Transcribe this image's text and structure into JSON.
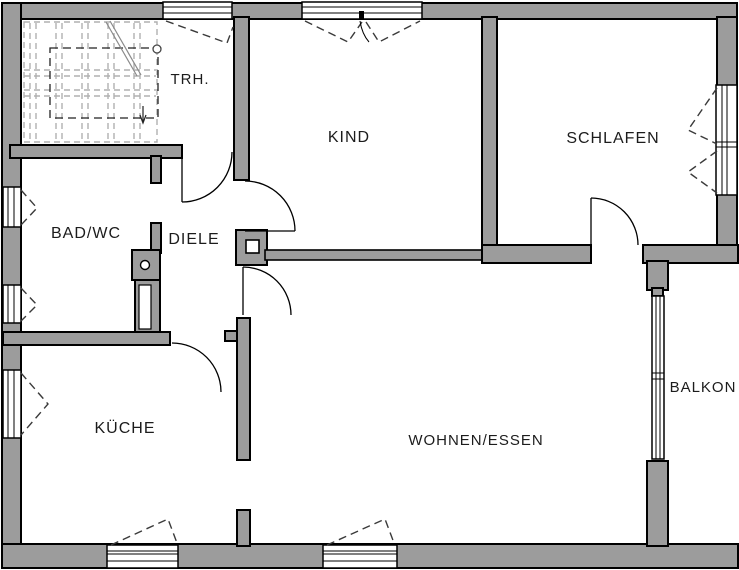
{
  "plan": {
    "type": "floor-plan",
    "language": "de",
    "rooms": [
      {
        "id": "trh",
        "label": "TRH."
      },
      {
        "id": "kind",
        "label": "KIND"
      },
      {
        "id": "schlafen",
        "label": "SCHLAFEN"
      },
      {
        "id": "bad-wc",
        "label": "BAD/WC"
      },
      {
        "id": "diele",
        "label": "DIELE"
      },
      {
        "id": "kueche",
        "label": "KÜCHE"
      },
      {
        "id": "wohnen-essen",
        "label": "WOHNEN/ESSEN"
      },
      {
        "id": "balkon",
        "label": "BALKON"
      }
    ],
    "colors": {
      "wall_fill": "#9c9c9c",
      "wall_stroke": "#000000",
      "background": "#ffffff",
      "label": "#1c1c1c",
      "stair_lines": "#b0b0b0"
    }
  }
}
